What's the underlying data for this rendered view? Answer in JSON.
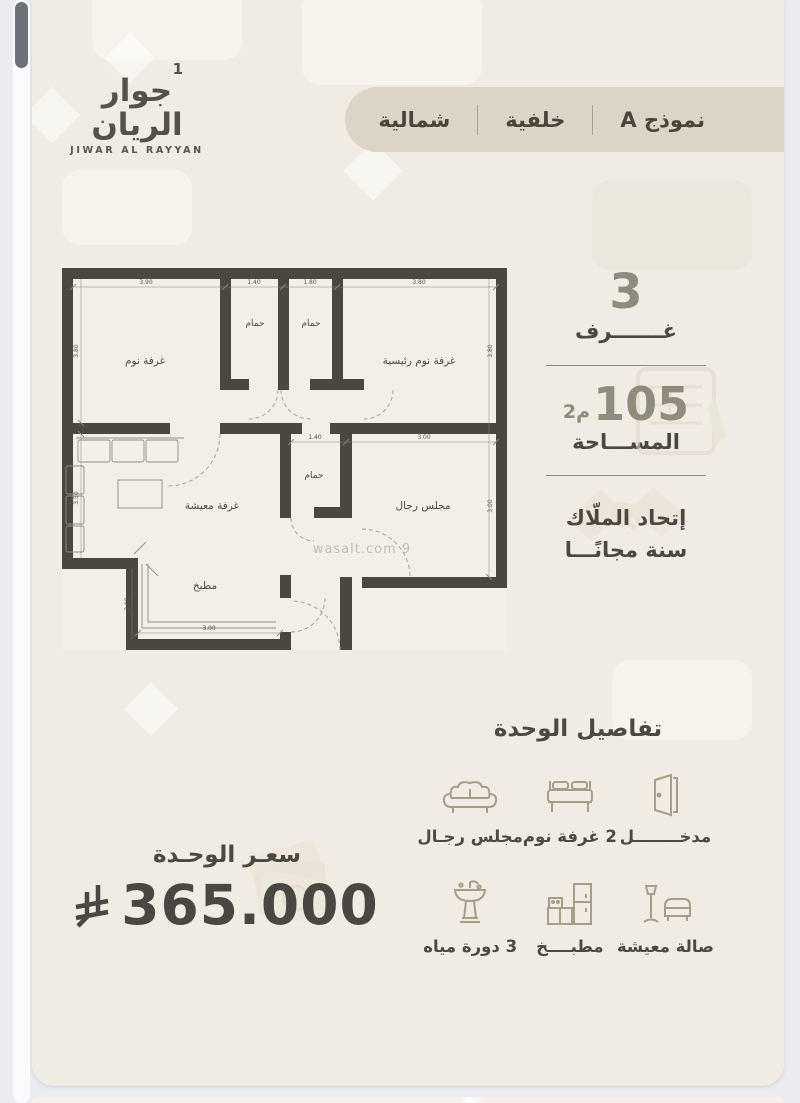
{
  "brand": {
    "logo_arabic": "جوار الريان",
    "logo_number": "1",
    "logo_latin": "JIWAR AL RAYYAN"
  },
  "tabs": [
    {
      "label": "نموذج A"
    },
    {
      "label": "خلفية"
    },
    {
      "label": "شمالية"
    }
  ],
  "floorplan": {
    "rooms": {
      "bedroom": "غرفة نوم",
      "bath": "حمام",
      "master_bedroom": "غرفة نوم رئيسية",
      "living": "غرفة معيشة",
      "majlis": "مجلس رجال",
      "kitchen": "مطبخ"
    },
    "dims": {
      "top": [
        "3.90",
        "1.40",
        "1.80",
        "3.80"
      ],
      "mid": [
        "1.40",
        "3.00"
      ],
      "kitchen_bottom": "3.00",
      "left_top": "3.80",
      "left_bottom": "3.50",
      "right_top": "3.80",
      "right_bottom": "3.00",
      "kitchen_left": "2.00"
    },
    "watermark": "wasalt.com 9"
  },
  "stats": {
    "rooms_count": "3",
    "rooms_label": "غـــــــرف",
    "area_value": "105",
    "area_unit": "م2",
    "area_label": "المســـاحة",
    "hoa_line1": "إتحاد الملّاك",
    "hoa_line2": "سنة مجانًـــا"
  },
  "details": {
    "title": "تفاصيل الوحدة",
    "items": [
      {
        "icon": "door-icon",
        "label": "مدخــــــــل"
      },
      {
        "icon": "bed-icon",
        "label": "2 غرفة نوم"
      },
      {
        "icon": "majlis-sofa-icon",
        "label": "مجلس رجـال"
      },
      {
        "icon": "living-room-icon",
        "label": "صالة معيشة"
      },
      {
        "icon": "kitchen-icon",
        "label": "مطبــــخ"
      },
      {
        "icon": "washbasin-icon",
        "label": "3 دورة مياه"
      }
    ]
  },
  "price": {
    "label": "سعـر الوحـدة",
    "value": "365.000",
    "currency_icon": "saudi-riyal-symbol"
  },
  "colors": {
    "card_bg": "#f1ece3",
    "pill_bg": "#dbd5c7",
    "wall": "#4a473e",
    "muted_number": "#8f8c7d",
    "text_dark": "#4b4a40",
    "icon_khaki": "#a49f86",
    "watermark": "#c2beb1"
  }
}
